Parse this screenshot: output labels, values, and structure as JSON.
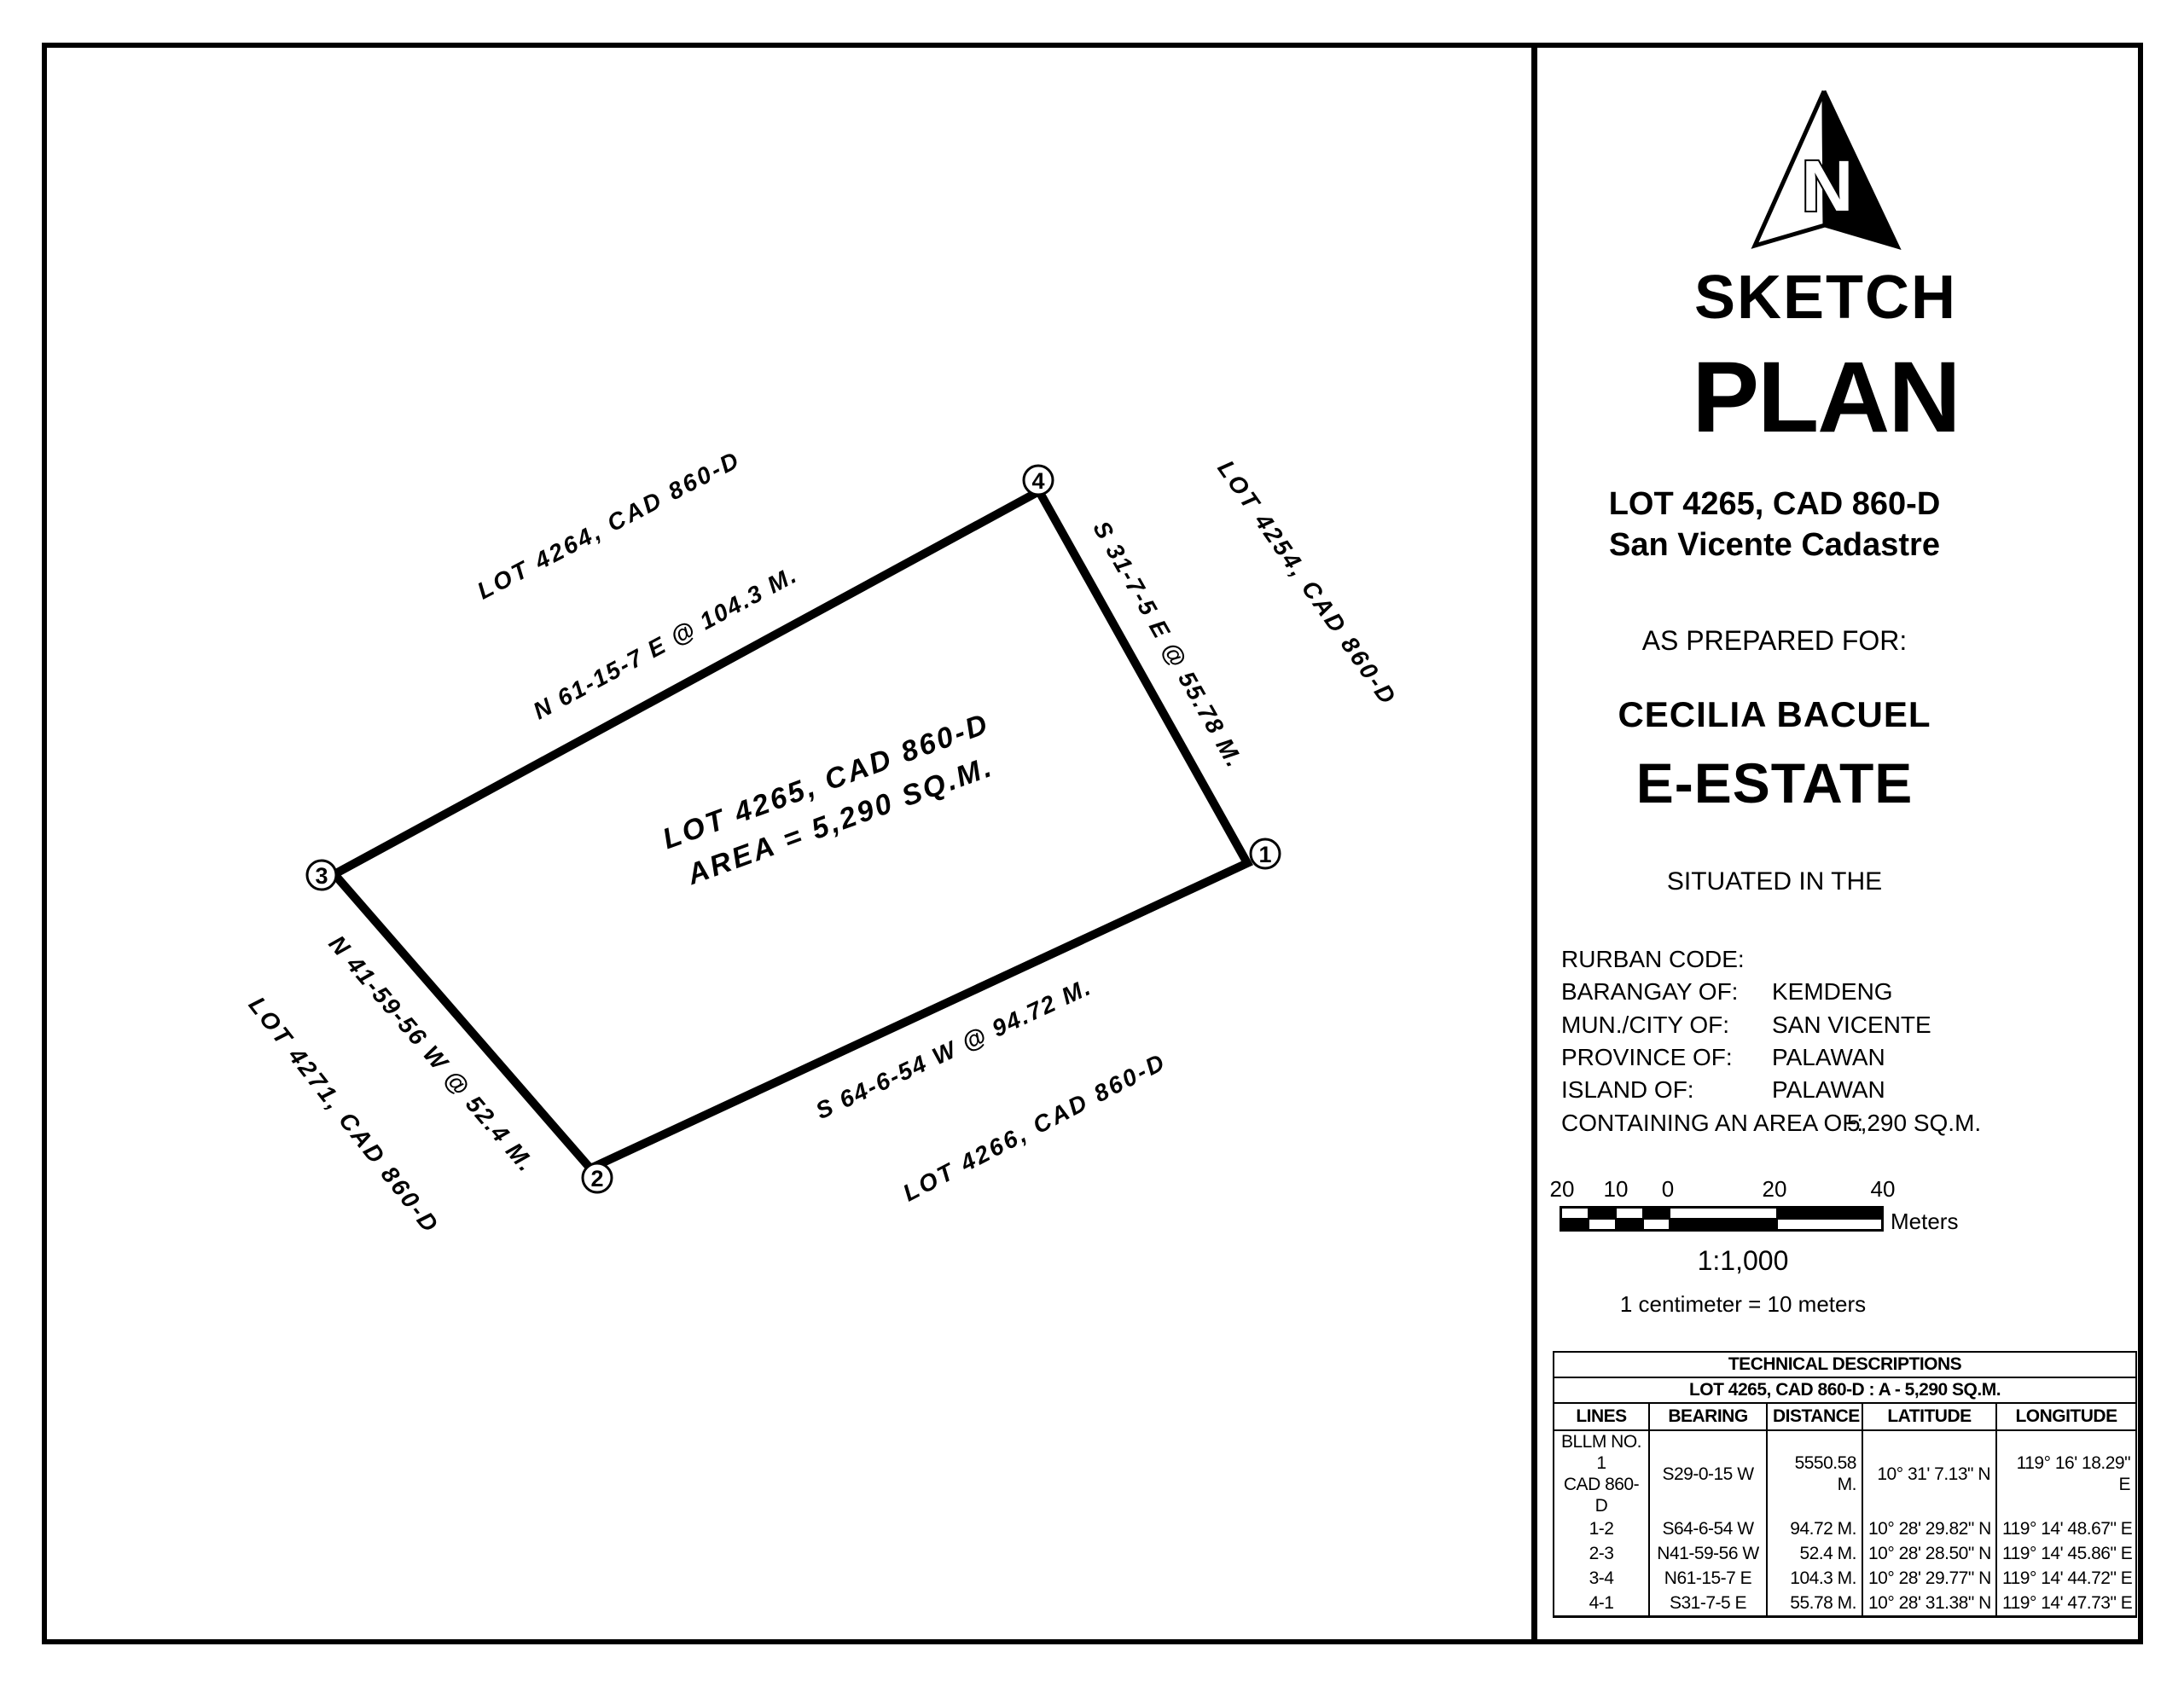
{
  "drawing": {
    "corners": [
      "1",
      "2",
      "3",
      "4"
    ],
    "center_label": {
      "line1": "LOT 4265, CAD 860-D",
      "line2": "AREA = 5,290 SQ.M."
    },
    "edge_labels": [
      {
        "text": "N 61-15-7 E @ 104.3 M."
      },
      {
        "text": "S 31-7-5 E @ 55.78 M."
      },
      {
        "text": "S 64-6-54 W @ 94.72 M."
      },
      {
        "text": "N 41-59-56 W @ 52.4 M."
      }
    ],
    "adjacent_lots": [
      {
        "text": "LOT 4264, CAD 860-D"
      },
      {
        "text": "LOT 4254, CAD 860-D"
      },
      {
        "text": "LOT 4266, CAD 860-D"
      },
      {
        "text": "LOT 4271, CAD 860-D"
      }
    ]
  },
  "title_block": {
    "north_label": "N",
    "sketch": "SKETCH",
    "plan": "PLAN",
    "lot_title": "LOT 4265, CAD 860-D",
    "cadastre": "San Vicente Cadastre",
    "prepared_for_label": "AS PREPARED FOR:",
    "client_name": "CECILIA BACUEL",
    "client_org": "E-ESTATE",
    "situated_label": "SITUATED IN THE",
    "location_rows": [
      {
        "label": "RURBAN CODE:",
        "value": ""
      },
      {
        "label": "BARANGAY OF:",
        "value": "KEMDENG"
      },
      {
        "label": "MUN./CITY OF:",
        "value": "SAN VICENTE"
      },
      {
        "label": "PROVINCE OF:",
        "value": "PALAWAN"
      },
      {
        "label": "ISLAND OF:",
        "value": "PALAWAN"
      },
      {
        "label": "CONTAINING AN AREA OF:",
        "value": "5,290 SQ.M."
      }
    ],
    "scale_bar": {
      "ticks": [
        "20",
        "10",
        "0",
        "20",
        "40"
      ],
      "unit": "Meters",
      "ratio": "1:1,000",
      "equivalence": "1 centimeter = 10 meters"
    },
    "table": {
      "title": "TECHNICAL DESCRIPTIONS",
      "subtitle": "LOT 4265, CAD 860-D  :  A - 5,290 SQ.M.",
      "headers": [
        "LINES",
        "BEARING",
        "DISTANCE",
        "LATITUDE",
        "LONGITUDE"
      ],
      "rows": [
        [
          "BLLM NO. 1\nCAD 860-D",
          "S29-0-15 W",
          "5550.58 M.",
          "10° 31' 7.13\" N",
          "119° 16' 18.29\" E"
        ],
        [
          "1-2",
          "S64-6-54 W",
          "94.72 M.",
          "10° 28' 29.82\" N",
          "119° 14' 48.67\" E"
        ],
        [
          "2-3",
          "N41-59-56 W",
          "52.4 M.",
          "10° 28' 28.50\" N",
          "119° 14' 45.86\" E"
        ],
        [
          "3-4",
          "N61-15-7 E",
          "104.3 M.",
          "10° 28' 29.77\" N",
          "119° 14' 44.72\" E"
        ],
        [
          "4-1",
          "S31-7-5 E",
          "55.78 M.",
          "10° 28' 31.38\" N",
          "119° 14' 47.73\" E"
        ]
      ]
    }
  }
}
